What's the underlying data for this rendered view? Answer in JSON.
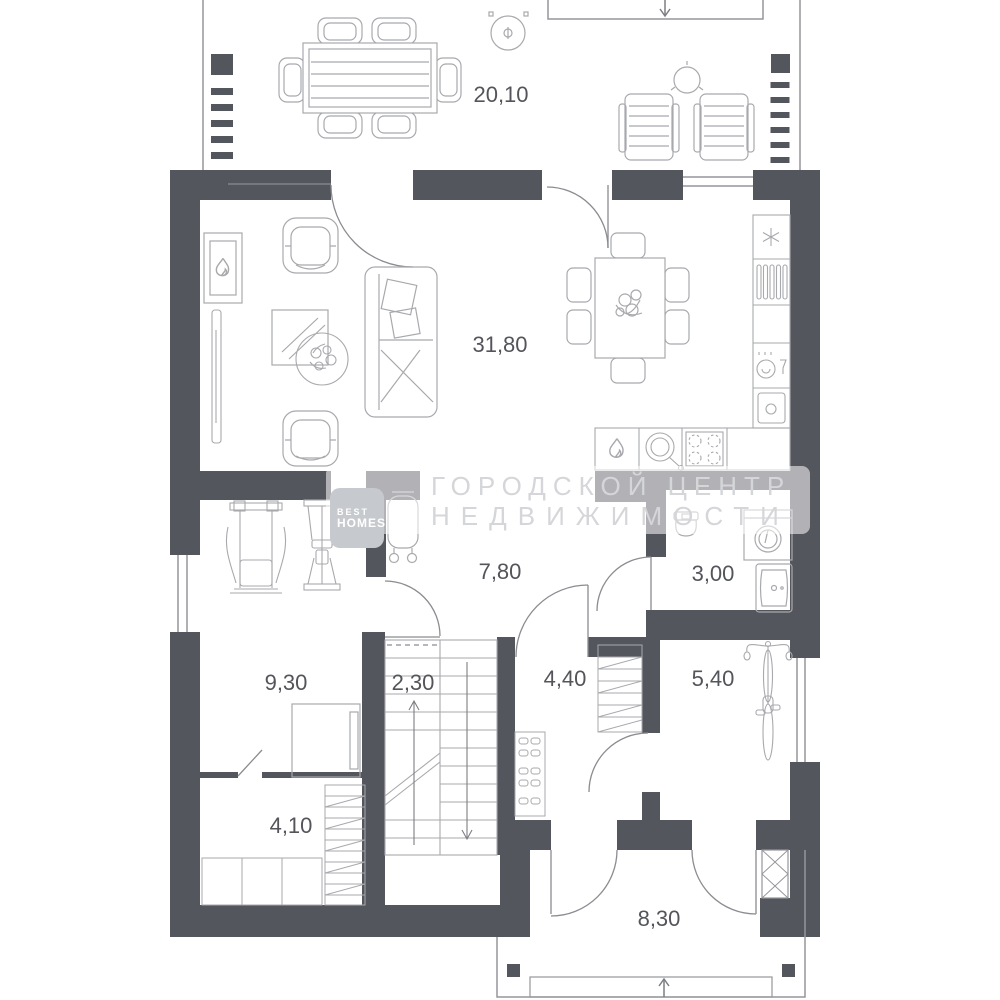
{
  "plan": {
    "title": "house floor plan, first floor",
    "rooms": [
      {
        "id": "terrace",
        "area": "20,10"
      },
      {
        "id": "living-dining-room",
        "area": "31,80"
      },
      {
        "id": "hallway",
        "area": "7,80"
      },
      {
        "id": "bathroom",
        "area": "3,00"
      },
      {
        "id": "room-with-gym",
        "area": "9,30"
      },
      {
        "id": "staircase",
        "area": "2,30"
      },
      {
        "id": "entry-hall",
        "area": "4,40"
      },
      {
        "id": "storage-room",
        "area": "5,40"
      },
      {
        "id": "dressing-room",
        "area": "4,10"
      },
      {
        "id": "porch",
        "area": "8,30"
      }
    ]
  },
  "watermark": {
    "logo_line1": "BEST",
    "logo_line2": "HOMES",
    "text_line1": "ГОРОДСКОЙ ЦЕНТР",
    "text_line2": "НЕДВИЖИМОСТИ"
  },
  "colors": {
    "wall": "#54565e",
    "furniture_outline": "#a8a9ad",
    "thin_line": "#95969b",
    "label_text": "#53555a",
    "watermark_text": "#d5d6d9",
    "watermark_logo_bg": "#c6c9cd"
  }
}
